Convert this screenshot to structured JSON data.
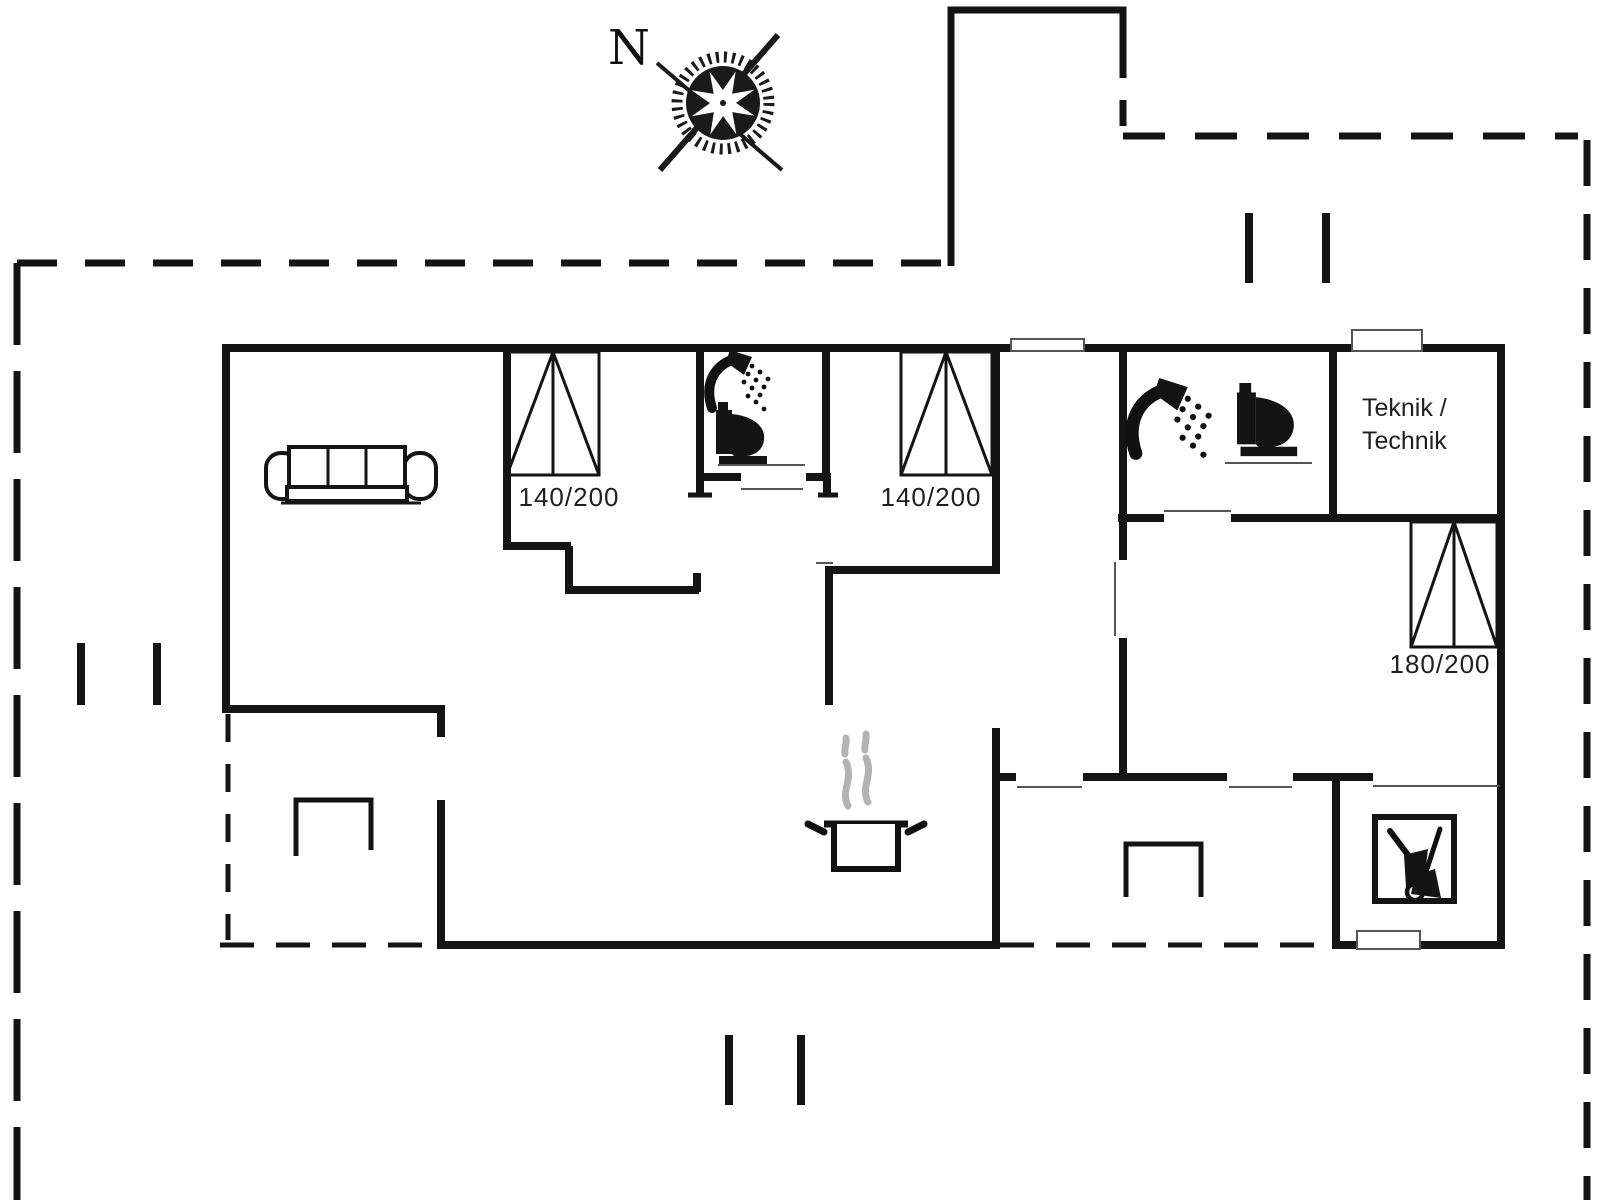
{
  "colors": {
    "wall": "#141414",
    "thin_line": "#555555",
    "steam": "#b3b3b3",
    "text": "#1f1f1f",
    "background": "#ffffff"
  },
  "compass": {
    "north_label": "N"
  },
  "bed_labels": {
    "bedroom1": "140/200",
    "bedroom2": "140/200",
    "bedroom3": "180/200"
  },
  "room_labels": {
    "technical_line1": "Teknik /",
    "technical_line2": "Technik"
  },
  "icons": {
    "compass-rose-icon": "compass rose with crossing needles",
    "sofa-icon": "three-seat sofa, top view",
    "double-bed-icon": "double bed symbol with center line and diagonals",
    "shower-icon": "shower head with water spray",
    "toilet-icon": "toilet, side view",
    "cooking-pot-icon": "steaming cooking pot (kitchen stove)",
    "garden-tools-icon": "wheelbarrow and broom in square (tool shed)",
    "terrace-bench-icon": "open rectangle terrace step/bench marker",
    "boundary-gate-icon": "double tick opening marker on plot boundary"
  }
}
